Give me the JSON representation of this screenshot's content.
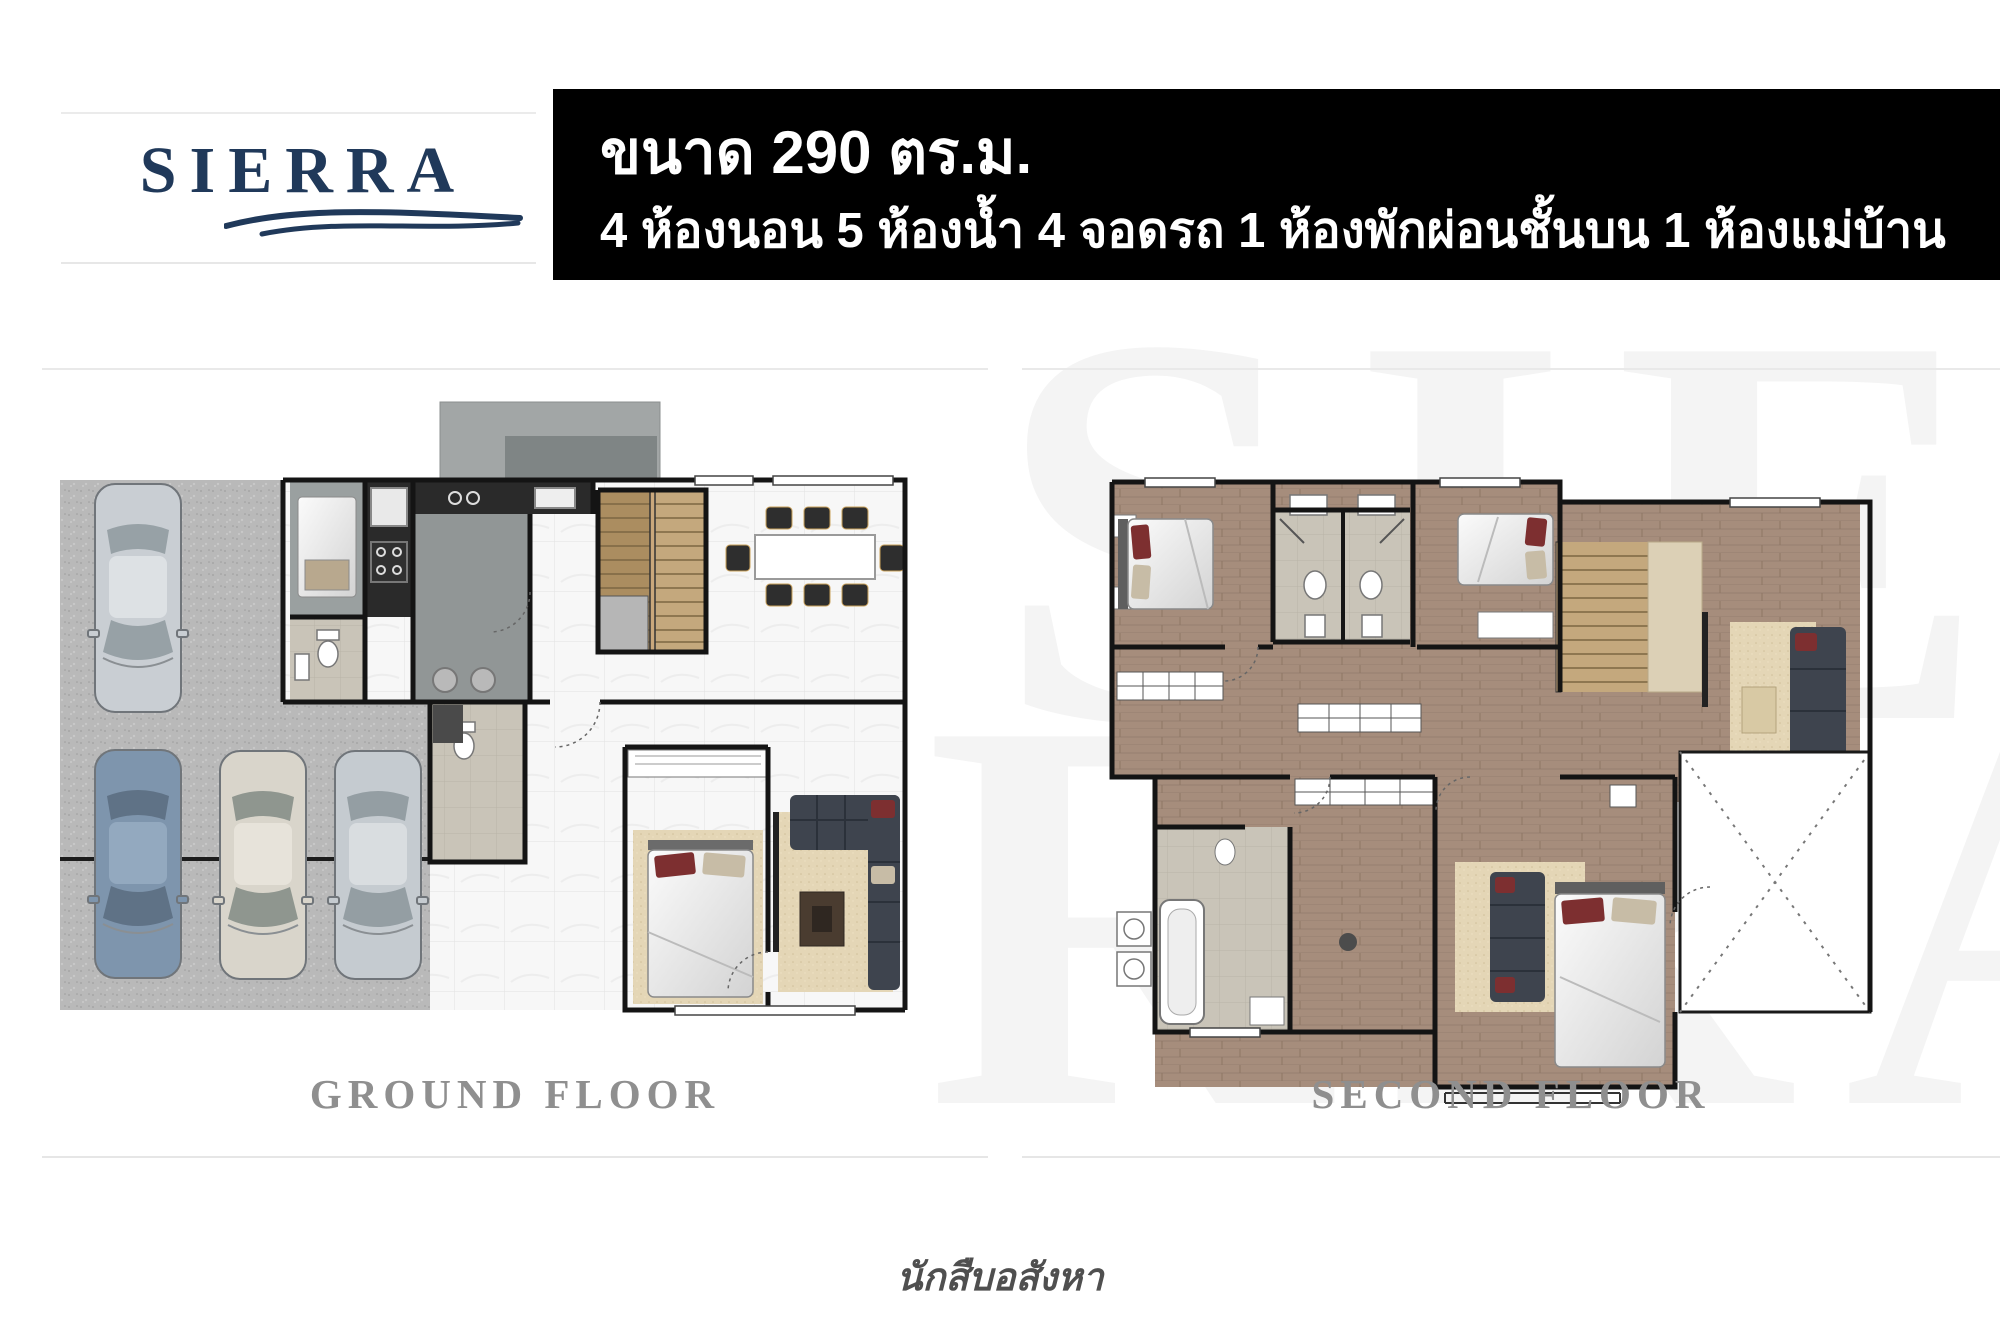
{
  "logo": {
    "brand": "SIERRA",
    "brand_color": "#20395a"
  },
  "banner": {
    "size_line": "ขนาด 290 ตร.ม.",
    "rooms_line": "4 ห้องนอน 5 ห้องน้ำ 4 จอดรถ 1 ห้องพักผ่อนชั้นบน 1 ห้องแม่บ้าน",
    "bg_color": "#000000",
    "text_color": "#ffffff"
  },
  "watermark": {
    "top_text": "SIE",
    "bottom_text": "RRA",
    "color": "#f4f4f4"
  },
  "plans": [
    {
      "label": "GROUND FLOOR",
      "features": [
        "carport-4-cars",
        "maid-room",
        "kitchen",
        "stairs",
        "dining-table-8-chairs",
        "bedroom",
        "living-room-sofa",
        "bathrooms-2"
      ]
    },
    {
      "label": "SECOND FLOOR",
      "features": [
        "bedroom-top-left",
        "shared-bathroom-twin-sinks",
        "bedroom-top-center",
        "stairs",
        "upper-lounge-sofa",
        "bathroom-with-tub",
        "walk-in-closet",
        "master-bedroom",
        "double-height-void"
      ]
    }
  ],
  "footer": {
    "credit": "นักสืบอสังหา",
    "text_color": "#4f4f4f"
  },
  "palette": {
    "label_gray": "#8f8f8f",
    "wall_black": "#141414",
    "wood_floor": "#a68d7c",
    "marble_floor": "#f7f7f7",
    "gravel": "#b9b9b9",
    "stair_wood": "#c4a87d",
    "rug_beige": "#e4d6b6",
    "sofa_dark": "#3e444e",
    "pillow_red": "#7d2f30",
    "pillow_tan": "#c7bca6",
    "bath_taupe": "#c9c4b8",
    "car_blue": "#7e95ad",
    "car_silver": "#c9ced3",
    "car_white": "#d9d5cb"
  }
}
